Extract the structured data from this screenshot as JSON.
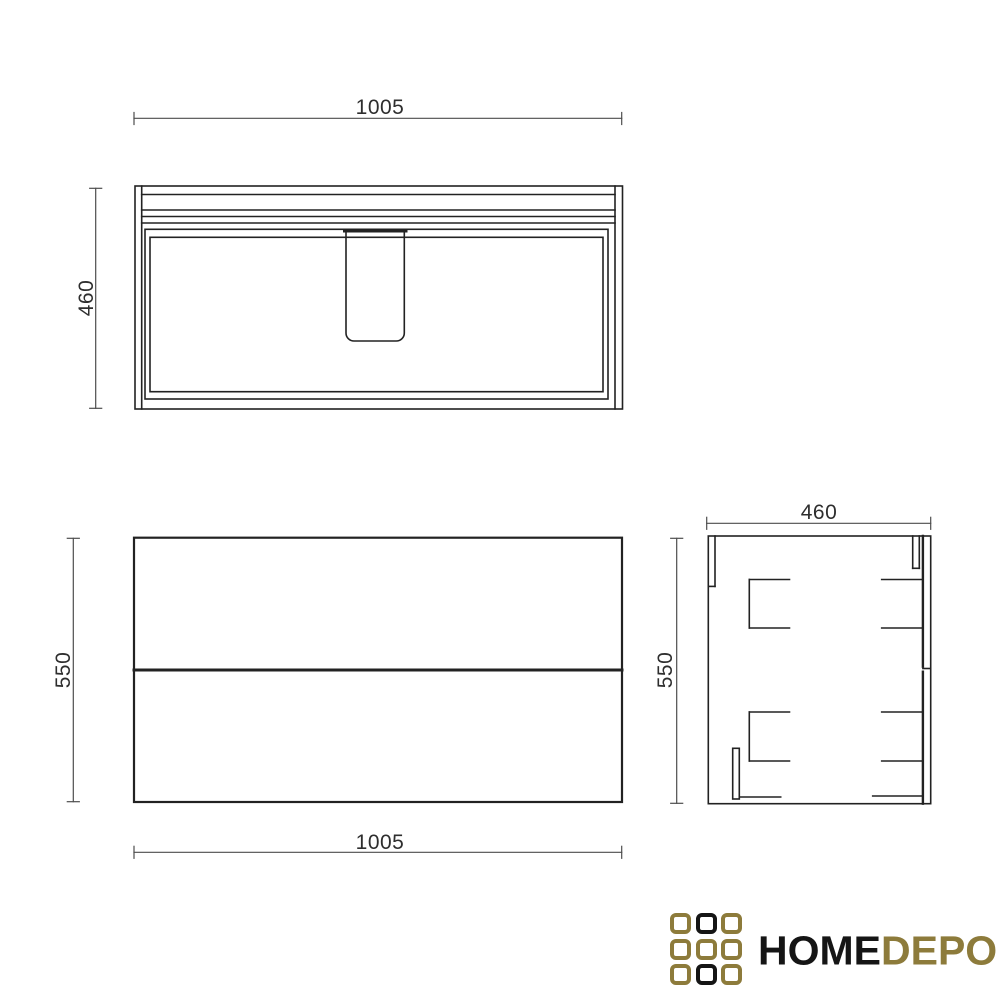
{
  "dims": {
    "top_width": {
      "label": "1005"
    },
    "top_height": {
      "label": "460"
    },
    "front_width": {
      "label": "1005"
    },
    "front_height": {
      "label": "550"
    },
    "side_width": {
      "label": "460"
    },
    "side_height": {
      "label": "550"
    }
  },
  "logo": {
    "text_black": "HOME",
    "text_gold": "DEPO",
    "grid": [
      [
        "gold",
        "black",
        "gold"
      ],
      [
        "gold",
        "gold",
        "gold"
      ],
      [
        "gold",
        "black",
        "gold"
      ]
    ],
    "colors": {
      "gold": "#8d7b3b",
      "black": "#151515"
    }
  },
  "colors": {
    "background": "#ffffff",
    "line": "#222222",
    "dim_line": "#4d4d4d",
    "dim_text": "#2e2e2e"
  }
}
